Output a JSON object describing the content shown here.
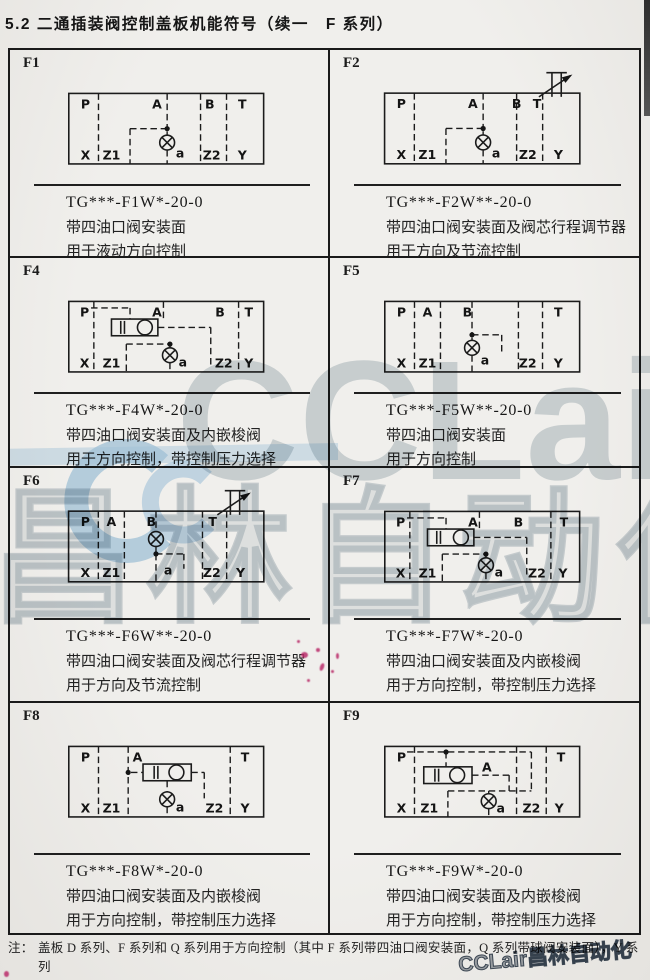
{
  "page": {
    "title": "5.2 二通插装阀控制盖板机能符号（续一　F 系列）"
  },
  "cells": [
    {
      "id": "F1",
      "code": "TG***-F1W*-20-0",
      "desc1": "带四油口阀安装面",
      "desc2": "用于液动方向控制",
      "ports_top": [
        "P",
        "A",
        "B",
        "T"
      ],
      "ports_bottom": [
        "X",
        "Z1",
        "Z2",
        "Y"
      ],
      "port_a": "a"
    },
    {
      "id": "F2",
      "code": "TG***-F2W**-20-0",
      "desc1": "带四油口阀安装面及阀芯行程调节器",
      "desc2": "用于方向及节流控制",
      "ports_top": [
        "P",
        "A",
        "B",
        "T"
      ],
      "ports_bottom": [
        "X",
        "Z1",
        "Z2",
        "Y"
      ],
      "port_a": "a"
    },
    {
      "id": "F4",
      "code": "TG***-F4W*-20-0",
      "desc1": "带四油口阀安装面及内嵌梭阀",
      "desc2": "用于方向控制，带控制压力选择",
      "ports_top": [
        "P",
        "A",
        "B",
        "T"
      ],
      "ports_bottom": [
        "X",
        "Z1",
        "Z2",
        "Y"
      ],
      "port_a": "a"
    },
    {
      "id": "F5",
      "code": "TG***-F5W**-20-0",
      "desc1": "带四油口阀安装面",
      "desc2": "用于方向控制",
      "ports_top": [
        "P",
        "A",
        "B",
        "T"
      ],
      "ports_bottom": [
        "X",
        "Z1",
        "Z2",
        "Y"
      ],
      "port_a": "a"
    },
    {
      "id": "F6",
      "code": "TG***-F6W**-20-0",
      "desc1": "带四油口阀安装面及阀芯行程调节器",
      "desc2": "用于方向及节流控制",
      "ports_top": [
        "P",
        "A",
        "B",
        "T"
      ],
      "ports_bottom": [
        "X",
        "Z1",
        "Z2",
        "Y"
      ],
      "port_a": "a"
    },
    {
      "id": "F7",
      "code": "TG***-F7W*-20-0",
      "desc1": "带四油口阀安装面及内嵌梭阀",
      "desc2": "用于方向控制，带控制压力选择",
      "ports_top": [
        "P",
        "A",
        "B",
        "T"
      ],
      "ports_bottom": [
        "X",
        "Z1",
        "Z2",
        "Y"
      ],
      "port_a": "a"
    },
    {
      "id": "F8",
      "code": "TG***-F8W*-20-0",
      "desc1": "带四油口阀安装面及内嵌梭阀",
      "desc2": "用于方向控制，带控制压力选择",
      "ports_top": [
        "P",
        "A",
        "T"
      ],
      "ports_bottom": [
        "X",
        "Z1",
        "Z2",
        "Y"
      ],
      "port_a": "a"
    },
    {
      "id": "F9",
      "code": "TG***-F9W*-20-0",
      "desc1": "带四油口阀安装面及内嵌梭阀",
      "desc2": "用于方向控制，带控制压力选择",
      "ports_top": [
        "P",
        "A",
        "T"
      ],
      "ports_bottom": [
        "X",
        "Z1",
        "Z2",
        "Y"
      ],
      "port_a": "a"
    }
  ],
  "footnote": {
    "label": "注：",
    "line1": "盖板 D 系列、F 系列和 Q 系列用于方向控制（其中 F 系列带四油口阀安装面，Q 系列带球阀安装面），Y 系列",
    "line2": "用于压力控制；J 系列用于组成减压控制单元。"
  },
  "watermark": {
    "big": "CCLair",
    "cn": "昌林自动化",
    "corner": "CCLair昌林自动化",
    "blue": "#a9cde7",
    "gray": "#94a4af"
  },
  "colors": {
    "paper": "#ecebe8",
    "ink": "#1b1b1b",
    "red_mark": "#ba2c6a"
  }
}
